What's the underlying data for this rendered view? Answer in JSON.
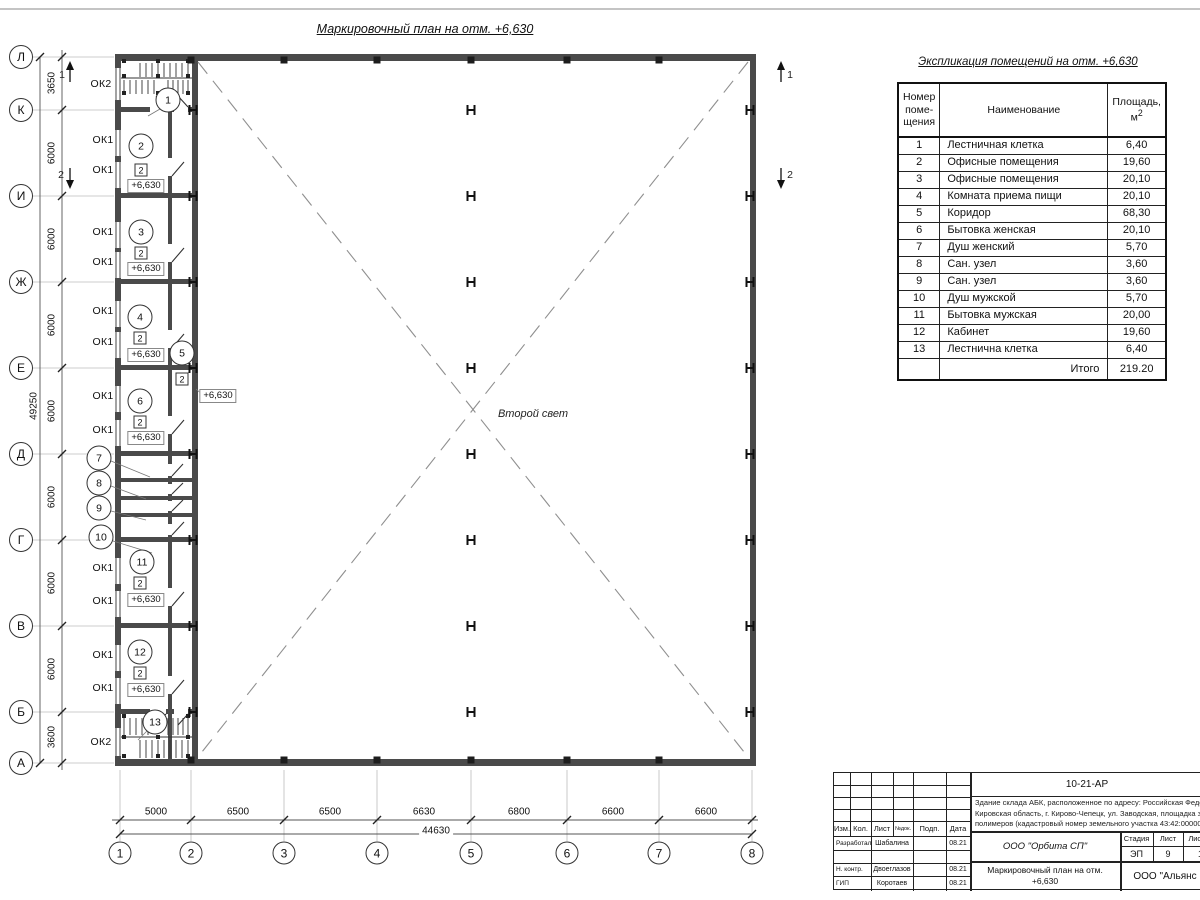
{
  "plan_title": "Маркировочный план на отм. +6,630",
  "plan": {
    "second_light": "Второй свет",
    "level_text": "+6,630",
    "floor_mark": "2",
    "total_width": "44630",
    "total_height": "49250",
    "row_axes": [
      {
        "l": "Л",
        "y": 57
      },
      {
        "l": "К",
        "y": 110
      },
      {
        "l": "И",
        "y": 196
      },
      {
        "l": "Ж",
        "y": 282
      },
      {
        "l": "Е",
        "y": 368
      },
      {
        "l": "Д",
        "y": 454
      },
      {
        "l": "Г",
        "y": 540
      },
      {
        "l": "В",
        "y": 626
      },
      {
        "l": "Б",
        "y": 712
      },
      {
        "l": "А",
        "y": 763
      }
    ],
    "col_axes": [
      {
        "l": "1",
        "x": 120
      },
      {
        "l": "2",
        "x": 191
      },
      {
        "l": "3",
        "x": 284
      },
      {
        "l": "4",
        "x": 377
      },
      {
        "l": "5",
        "x": 471
      },
      {
        "l": "6",
        "x": 567
      },
      {
        "l": "7",
        "x": 659
      },
      {
        "l": "8",
        "x": 752
      }
    ],
    "row_dims": [
      {
        "t": "3650",
        "y": 83
      },
      {
        "t": "6000",
        "y": 153
      },
      {
        "t": "6000",
        "y": 239
      },
      {
        "t": "6000",
        "y": 325
      },
      {
        "t": "6000",
        "y": 411
      },
      {
        "t": "6000",
        "y": 497
      },
      {
        "t": "6000",
        "y": 583
      },
      {
        "t": "6000",
        "y": 669
      },
      {
        "t": "3600",
        "y": 737
      }
    ],
    "col_dims": [
      {
        "t": "5000",
        "x": 156
      },
      {
        "t": "6500",
        "x": 238
      },
      {
        "t": "6500",
        "x": 330
      },
      {
        "t": "6630",
        "x": 424
      },
      {
        "t": "6800",
        "x": 519
      },
      {
        "t": "6600",
        "x": 613
      },
      {
        "t": "6600",
        "x": 706
      }
    ],
    "windows": [
      {
        "t": "ОК2",
        "x": 101,
        "y": 84
      },
      {
        "t": "ОК1",
        "x": 103,
        "y": 140
      },
      {
        "t": "ОК1",
        "x": 103,
        "y": 170
      },
      {
        "t": "ОК1",
        "x": 103,
        "y": 232
      },
      {
        "t": "ОК1",
        "x": 103,
        "y": 262
      },
      {
        "t": "ОК1",
        "x": 103,
        "y": 311
      },
      {
        "t": "ОК1",
        "x": 103,
        "y": 342
      },
      {
        "t": "ОК1",
        "x": 103,
        "y": 396
      },
      {
        "t": "ОК1",
        "x": 103,
        "y": 430
      },
      {
        "t": "ОК1",
        "x": 103,
        "y": 568
      },
      {
        "t": "ОК1",
        "x": 103,
        "y": 601
      },
      {
        "t": "ОК1",
        "x": 103,
        "y": 655
      },
      {
        "t": "ОК1",
        "x": 103,
        "y": 688
      },
      {
        "t": "ОК2",
        "x": 101,
        "y": 742
      }
    ],
    "rooms": [
      {
        "n": "1",
        "x": 168,
        "y": 100
      },
      {
        "n": "2",
        "x": 141,
        "y": 146
      },
      {
        "n": "3",
        "x": 141,
        "y": 232
      },
      {
        "n": "4",
        "x": 140,
        "y": 317
      },
      {
        "n": "5",
        "x": 182,
        "y": 353
      },
      {
        "n": "6",
        "x": 140,
        "y": 401
      },
      {
        "n": "7",
        "x": 99,
        "y": 458
      },
      {
        "n": "8",
        "x": 99,
        "y": 483
      },
      {
        "n": "9",
        "x": 99,
        "y": 508
      },
      {
        "n": "10",
        "x": 101,
        "y": 537
      },
      {
        "n": "11",
        "x": 142,
        "y": 562
      },
      {
        "n": "12",
        "x": 140,
        "y": 652
      },
      {
        "n": "13",
        "x": 155,
        "y": 722
      }
    ],
    "floor_marks": [
      {
        "x": 141,
        "y": 170
      },
      {
        "x": 141,
        "y": 253
      },
      {
        "x": 140,
        "y": 338
      },
      {
        "x": 182,
        "y": 379
      },
      {
        "x": 140,
        "y": 422
      },
      {
        "x": 140,
        "y": 583
      },
      {
        "x": 140,
        "y": 673
      }
    ],
    "level_marks": [
      {
        "x": 146,
        "y": 186
      },
      {
        "x": 146,
        "y": 269
      },
      {
        "x": 146,
        "y": 355
      },
      {
        "x": 146,
        "y": 438
      },
      {
        "x": 146,
        "y": 600
      },
      {
        "x": 146,
        "y": 690
      },
      {
        "x": 218,
        "y": 396
      }
    ],
    "h_rows": [
      110,
      196,
      282,
      368,
      454,
      540,
      626,
      712
    ],
    "post_xs": [
      191,
      284,
      377,
      471,
      567,
      659
    ],
    "sections": {
      "s1": "1",
      "s2": "2"
    }
  },
  "schedule": {
    "title": "Экспликация помещений на отм. +6,630",
    "col_num_header": "Номер\nпоме-\nщения",
    "col_name_header": "Наименование",
    "col_area_header": "Площадь,",
    "area_unit": "м",
    "area_sup": "2",
    "rows": [
      {
        "num": "1",
        "name": "Лестничная клетка",
        "area": "6,40"
      },
      {
        "num": "2",
        "name": "Офисные помещения",
        "area": "19,60"
      },
      {
        "num": "3",
        "name": "Офисные помещения",
        "area": "20,10"
      },
      {
        "num": "4",
        "name": "Комната приема пищи",
        "area": "20,10"
      },
      {
        "num": "5",
        "name": "Коридор",
        "area": "68,30"
      },
      {
        "num": "6",
        "name": "Бытовка женская",
        "area": "20,10"
      },
      {
        "num": "7",
        "name": "Душ женский",
        "area": "5,70"
      },
      {
        "num": "8",
        "name": "Сан. узел",
        "area": "3,60"
      },
      {
        "num": "9",
        "name": "Сан. узел",
        "area": "3,60"
      },
      {
        "num": "10",
        "name": "Душ мужской",
        "area": "5,70"
      },
      {
        "num": "11",
        "name": "Бытовка мужская",
        "area": "20,00"
      },
      {
        "num": "12",
        "name": "Кабинет",
        "area": "19,60"
      },
      {
        "num": "13",
        "name": "Лестнична клетка",
        "area": "6,40"
      }
    ],
    "total_label": "Итого",
    "total_value": "219.20"
  },
  "titleblock": {
    "doc_number": "10-21-АР",
    "address_lines": [
      "Здание склада АБК, расположенное по адресу: Российская Федерация,",
      "Кировская область, г. Кирово-Чепецк, ул. Заводская, площадка завода",
      "полимеров (кадастровый номер земельного участка 43:42:000000)"
    ],
    "header": {
      "izm": "Изм.",
      "kol": "Кол.",
      "list": "Лист",
      "ndok": "№док.",
      "podp": "Подп.",
      "data": "Дата"
    },
    "rows": [
      {
        "role": "Разработал",
        "name": "Шабалина",
        "date": "08.21"
      },
      {
        "role": "Н. контр.",
        "name": "Двоеглазов",
        "date": "08.21"
      },
      {
        "role": "ГИП",
        "name": "Коротаев",
        "date": "08.21"
      }
    ],
    "org": "ООО \"Орбита СП\"",
    "stage_label": "Стадия",
    "sheet_label": "Лист",
    "sheets_label": "Листов",
    "stage": "ЭП",
    "sheet": "9",
    "sheets": "1",
    "doc_title": "Маркировочный план на отм.\n+6,630",
    "org2": "ООО \"Альянс"
  }
}
